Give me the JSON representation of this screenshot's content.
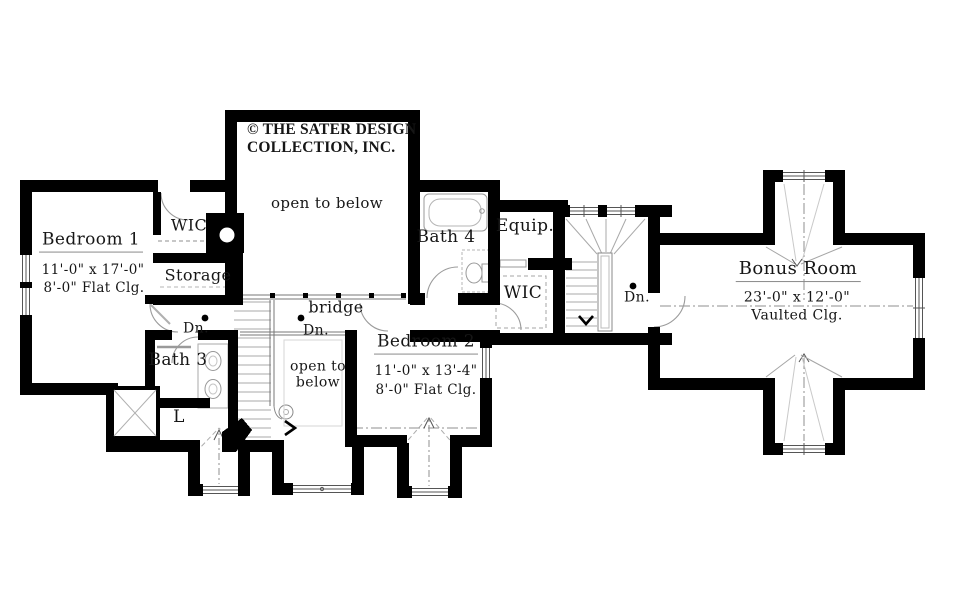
{
  "colors": {
    "walls": "#000000",
    "linework": "#999999",
    "text": "#161616"
  },
  "copyright": {
    "line1": "© THE SATER DESIGN",
    "line2": "COLLECTION, INC."
  },
  "rooms": {
    "bedroom1": {
      "name": "Bedroom 1",
      "dims": "11'-0\" x 17'-0\"",
      "ceiling": "8'-0\" Flat Clg."
    },
    "bedroom2": {
      "name": "Bedroom 2",
      "dims": "11'-0\" x 13'-4\"",
      "ceiling": "8'-0\" Flat Clg."
    },
    "bonus_room": {
      "name": "Bonus Room",
      "dims": "23'-0\" x 12'-0\"",
      "ceiling": "Vaulted Clg."
    },
    "bath3": {
      "name": "Bath 3"
    },
    "bath4": {
      "name": "Bath 4"
    },
    "wic_bedroom1": {
      "name": "WIC"
    },
    "wic_hall": {
      "name": "WIC"
    },
    "storage": {
      "name": "Storage"
    },
    "equipment": {
      "name": "Equip."
    },
    "laundry": {
      "name": "L"
    },
    "bridge": {
      "name": "bridge"
    }
  },
  "annotations": {
    "open_to_below_main": "open to below",
    "open_to_below_2_line1": "open to",
    "open_to_below_2_line2": "below",
    "down_left": "Dn.",
    "down_bridge": "Dn.",
    "down_stair_hall": "Dn."
  }
}
